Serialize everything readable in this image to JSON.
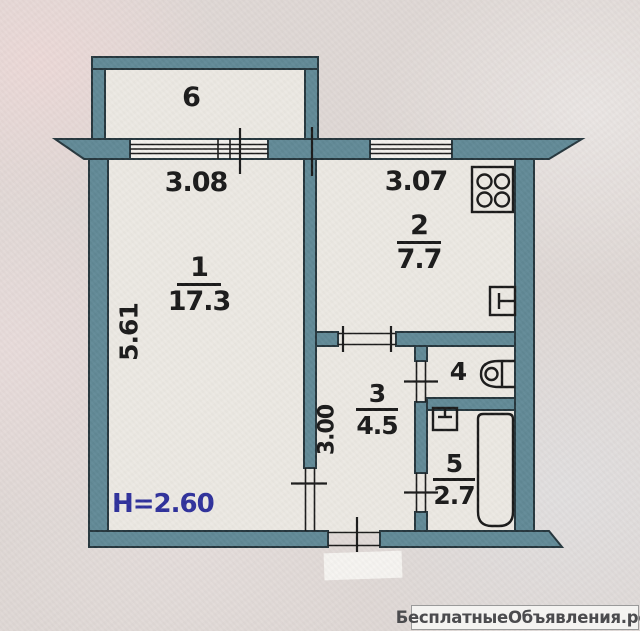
{
  "colors": {
    "wall-fill": "#5e8794",
    "wall-stroke": "#22333a",
    "ink": "#161616",
    "room-bg": "#ebe8e2",
    "paper": "#ded7d4",
    "accent-blue": "#2b2d9a",
    "watermark-ink": "#4b4b4e",
    "watermark-bg": "#f4f3f1"
  },
  "rooms": [
    {
      "name": "living-room",
      "number": "1",
      "area": "17.3"
    },
    {
      "name": "kitchen",
      "number": "2",
      "area": "7.7"
    },
    {
      "name": "hallway",
      "number": "3",
      "area": "4.5"
    },
    {
      "name": "toilet",
      "number": "4",
      "area": ""
    },
    {
      "name": "bathroom",
      "number": "5",
      "area": "2.7"
    },
    {
      "name": "balcony",
      "number": "6",
      "area": ""
    }
  ],
  "dimensions": {
    "living_room_width": "3.08",
    "kitchen_width": "3.07",
    "living_room_depth": "5.61",
    "hallway_depth": "3.00",
    "ceiling_height": "H=2.60"
  },
  "fixtures": [
    "stove",
    "kitchen-sink",
    "toilet",
    "washbasin",
    "bathtub"
  ],
  "watermark": "БесплатныеОбъявления.рф"
}
